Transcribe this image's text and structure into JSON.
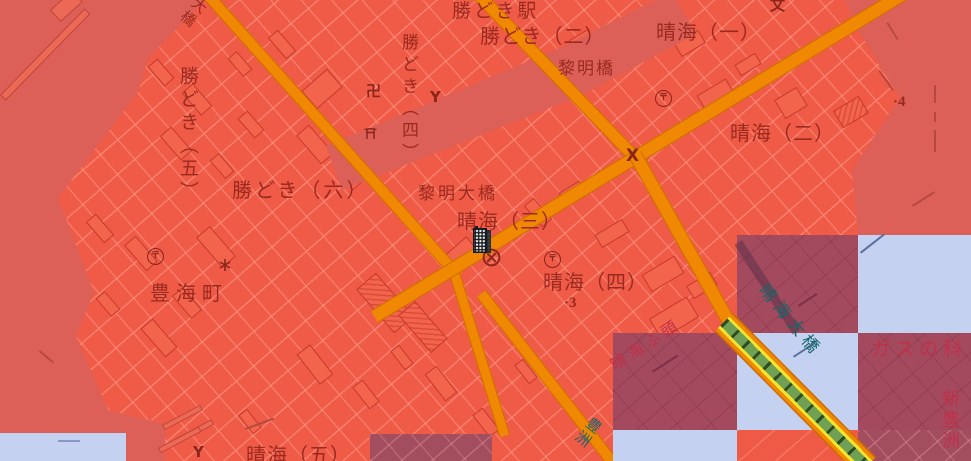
{
  "map": {
    "description": "Red flood-hazard overlay on Japanese GSI base map, Kachidoki / Harumi waterfront, with checkerboard overlay tiles",
    "colors": {
      "overlay_land": "#ef5b47",
      "overlay_water": "#dc6057",
      "tile_dark": "#a34a5f",
      "tile_dark_land": "#a24e5e",
      "tile_clear_water": "#c5d1f1",
      "road_fill": "#f08804",
      "road_edge": "#cc6d00",
      "bridge_yellow": "#f3e42d",
      "bridge_green": "#6fa053",
      "label_dark_red": "#9a2a1f",
      "label_crimson": "#c13049",
      "label_teal": "#166769",
      "building_edge": "#c8392a"
    },
    "place_labels": [
      {
        "id": "kachidoki-station",
        "text": "勝どき駅",
        "x": 452,
        "y": 2,
        "size": 19,
        "spacing": 3
      },
      {
        "id": "kachidoki-2chome",
        "text": "勝どき（二）",
        "x": 480,
        "y": 26,
        "size": 20,
        "spacing": 1
      },
      {
        "id": "harumi-1chome",
        "text": "晴海（一）",
        "x": 656,
        "y": 22,
        "size": 20,
        "spacing": 1
      },
      {
        "id": "reimei-bridge",
        "text": "黎明橋",
        "x": 558,
        "y": 61,
        "size": 17,
        "spacing": 2
      },
      {
        "id": "kachidoki-4chome",
        "text": "勝どき（四）",
        "x": 399,
        "y": 33,
        "size": 17,
        "vertical": true,
        "spacing": 5
      },
      {
        "id": "kachidoki-5chome",
        "text": "勝どき（五）",
        "x": 178,
        "y": 66,
        "size": 19,
        "vertical": true,
        "spacing": 4
      },
      {
        "id": "kachidoki-6chome",
        "text": "勝どき（六）",
        "x": 232,
        "y": 180,
        "size": 20,
        "spacing": 3
      },
      {
        "id": "harumi-2chome",
        "text": "晴海（二）",
        "x": 730,
        "y": 123,
        "size": 20,
        "spacing": 1
      },
      {
        "id": "reimei-ohashi-bridge",
        "text": "黎明大橋",
        "x": 418,
        "y": 186,
        "size": 17,
        "spacing": 3
      },
      {
        "id": "harumi-3chome",
        "text": "晴海（三）",
        "x": 457,
        "y": 211,
        "size": 20,
        "spacing": 1
      },
      {
        "id": "toyomi-cho",
        "text": "豊海町",
        "x": 150,
        "y": 283,
        "size": 20,
        "spacing": 6
      },
      {
        "id": "harumi-4chome",
        "text": "晴海（四）",
        "x": 543,
        "y": 272,
        "size": 20,
        "spacing": 1
      },
      {
        "id": "harumi-wharf",
        "text": "晴海ふ頭",
        "x": 608,
        "y": 360,
        "size": 16,
        "rotate": -33,
        "color": "crimson",
        "spacing": 4
      },
      {
        "id": "harumi-ohashi-bridge",
        "text": "晴海大橋",
        "x": 768,
        "y": 282,
        "size": 17,
        "rotate": 50,
        "color": "teal",
        "spacing": 5
      },
      {
        "id": "gas-science-museum",
        "text": "ガスの科",
        "x": 871,
        "y": 340,
        "size": 19,
        "color": "crimson",
        "spacing": 5
      },
      {
        "id": "shin-toyosu",
        "text": "新豊洲",
        "x": 940,
        "y": 389,
        "size": 18,
        "vertical": true,
        "color": "crimson",
        "spacing": 3
      },
      {
        "id": "toyosu",
        "text": "豊洲",
        "x": 592,
        "y": 414,
        "size": 15,
        "vertical": true,
        "rotate": 38,
        "color": "teal",
        "spacing": 2
      },
      {
        "id": "harumi-5chome",
        "text": "晴海（五）",
        "x": 246,
        "y": 445,
        "size": 20,
        "spacing": 1
      },
      {
        "id": "ohashi-bridge",
        "text": "大橋",
        "x": 198,
        "y": -6,
        "size": 15,
        "vertical": true,
        "rotate": 40,
        "spacing": 2
      },
      {
        "id": "spot-elevation-4",
        "text": "·4",
        "x": 893,
        "y": 95,
        "size": 15,
        "serif": true
      },
      {
        "id": "spot-elevation-3",
        "text": "·3",
        "x": 564,
        "y": 296,
        "size": 15,
        "serif": true
      }
    ],
    "symbols": [
      {
        "name": "post-office-icon",
        "type": "post",
        "glyph": "〒",
        "x": 655,
        "y": 90,
        "s": 17
      },
      {
        "name": "post-office-icon",
        "type": "post",
        "glyph": "〒",
        "x": 147,
        "y": 248,
        "s": 17
      },
      {
        "name": "post-office-icon",
        "type": "post",
        "glyph": "〒",
        "x": 544,
        "y": 251,
        "s": 17
      },
      {
        "name": "police-station-icon",
        "type": "circle-x",
        "x": 482,
        "y": 248,
        "s": 19
      },
      {
        "name": "police-box-icon",
        "type": "text",
        "glyph": "X",
        "x": 626,
        "y": 148,
        "s": 17
      },
      {
        "name": "fire-station-icon",
        "type": "text",
        "glyph": "Y",
        "x": 430,
        "y": 90,
        "s": 15
      },
      {
        "name": "fire-station-icon",
        "type": "text",
        "glyph": "Y",
        "x": 193,
        "y": 445,
        "s": 15
      },
      {
        "name": "temple-manji-icon",
        "type": "text",
        "glyph": "卍",
        "x": 366,
        "y": 84,
        "s": 15
      },
      {
        "name": "shrine-torii-icon",
        "type": "torii",
        "x": 364,
        "y": 128,
        "s": 13
      },
      {
        "name": "school-icon",
        "type": "text",
        "glyph": "文",
        "x": 770,
        "y": -2,
        "s": 15
      },
      {
        "name": "lighthouse-icon",
        "type": "star",
        "x": 218,
        "y": 258,
        "s": 14
      }
    ],
    "overlay_tiles": [
      {
        "x": 737,
        "y": 235,
        "w": 121,
        "h": 98,
        "kind": "dark"
      },
      {
        "x": 858,
        "y": 235,
        "w": 113,
        "h": 98,
        "kind": "clear"
      },
      {
        "x": 613,
        "y": 333,
        "w": 124,
        "h": 97,
        "kind": "dark"
      },
      {
        "x": 737,
        "y": 333,
        "w": 121,
        "h": 97,
        "kind": "clear"
      },
      {
        "x": 858,
        "y": 333,
        "w": 113,
        "h": 97,
        "kind": "dark"
      },
      {
        "x": 613,
        "y": 430,
        "w": 124,
        "h": 31,
        "kind": "clear"
      },
      {
        "x": 737,
        "y": 430,
        "w": 121,
        "h": 31,
        "kind": "plain"
      },
      {
        "x": 858,
        "y": 430,
        "w": 113,
        "h": 31,
        "kind": "darkland"
      },
      {
        "x": 370,
        "y": 434,
        "w": 122,
        "h": 27,
        "kind": "darkland"
      },
      {
        "x": 0,
        "y": 433,
        "w": 126,
        "h": 28,
        "kind": "clear"
      }
    ],
    "marker": {
      "name": "building-marker",
      "x": 472,
      "y": 226
    }
  }
}
